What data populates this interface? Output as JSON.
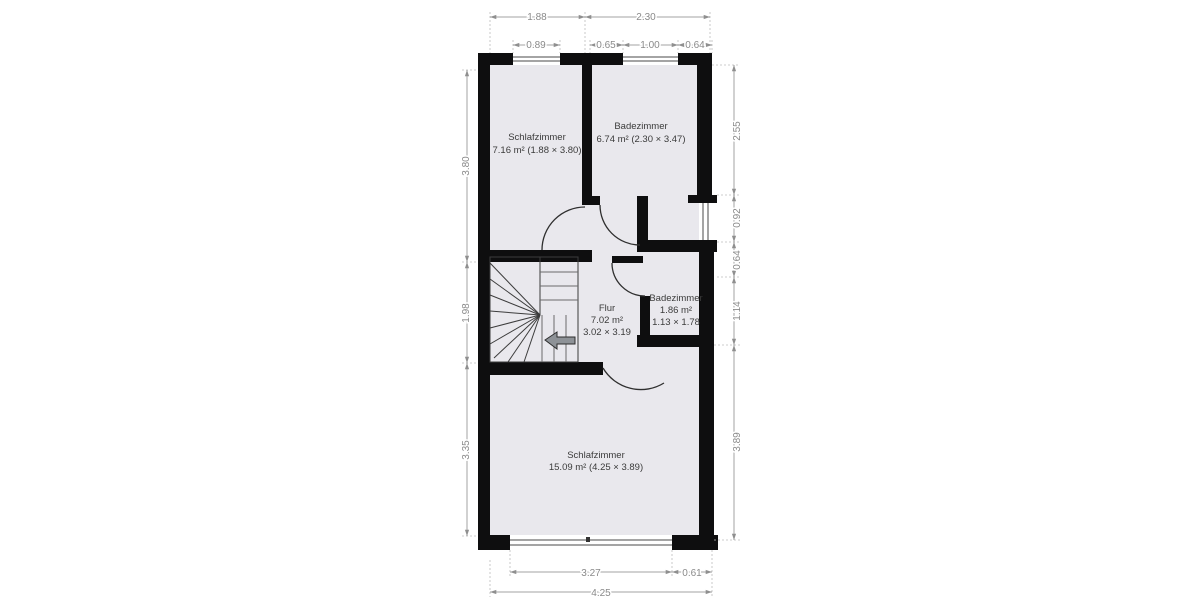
{
  "plan": {
    "rooms": [
      {
        "id": "schlafzimmer-top",
        "label": "Schlafzimmer",
        "area": "7.16 m² (1.88 × 3.80)"
      },
      {
        "id": "badezimmer-top",
        "label": "Badezimmer",
        "area": "6.74 m² (2.30 × 3.47)"
      },
      {
        "id": "badezimmer-small",
        "label": "Badezimmer",
        "area": "1.86 m²",
        "dims": "1.13 × 1.78"
      },
      {
        "id": "flur",
        "label": "Flur",
        "area": "7.02 m²",
        "dims": "3.02 × 3.19"
      },
      {
        "id": "schlafzimmer-bottom",
        "label": "Schlafzimmer",
        "area": "15.09 m² (4.25 × 3.89)"
      }
    ],
    "dimensions": {
      "top_row1": [
        "1.88",
        "2.30"
      ],
      "top_row2": [
        "0.89",
        "0.65",
        "1.00",
        "0.64"
      ],
      "left": [
        "3.80",
        "1.98",
        "3.35"
      ],
      "right": [
        "2.55",
        "0.92",
        "0.64",
        "1.14",
        "3.89"
      ],
      "bottom_row1": [
        "3.27",
        "0.61"
      ],
      "bottom_row2": [
        "4.25"
      ]
    },
    "colors": {
      "wall": "#0e0e0f",
      "room_fill": "#e9e8ed",
      "dimension": "#8a8a8a",
      "label": "#3b3b3b"
    }
  }
}
